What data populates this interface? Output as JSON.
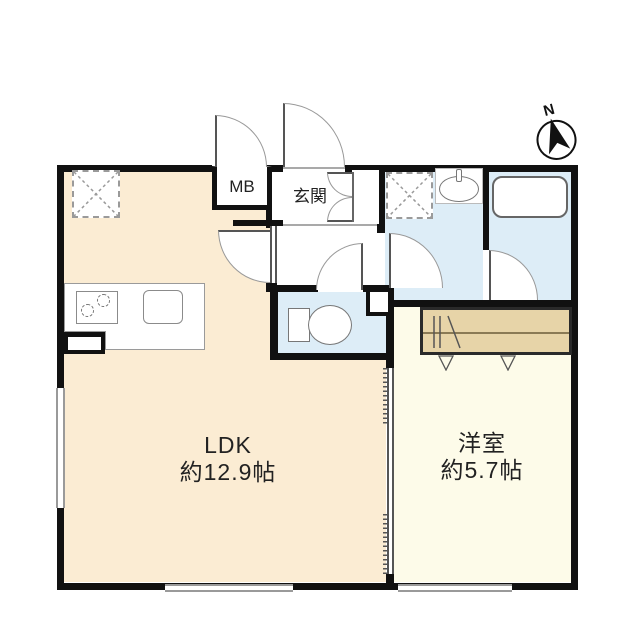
{
  "plan_title": "1LDK floor plan",
  "compass": {
    "label": "N"
  },
  "rooms": {
    "ldk": {
      "label": "LDK",
      "area": "約12.9帖"
    },
    "western": {
      "label": "洋室",
      "area": "約5.7帖"
    },
    "entrance": {
      "label": "玄関"
    },
    "meter_box": {
      "label": "MB"
    }
  },
  "fixtures": {
    "kitchen": "stove-and-sink-counter",
    "refrigerator_space": "dashed-cross-square",
    "washing_machine_space": "dashed-cross-square",
    "toilet": "toilet-icon",
    "bathtub": "bathtub-icon",
    "wash_basin": "basin-icon",
    "closet": "closet-with-hanger-pole"
  },
  "colors": {
    "ldk_floor": "#fbecd3",
    "western_floor": "#fdfbe9",
    "wet_area_floor": "#ddedf7",
    "closet_fill": "#e7d4a8",
    "wall": "#111111"
  }
}
